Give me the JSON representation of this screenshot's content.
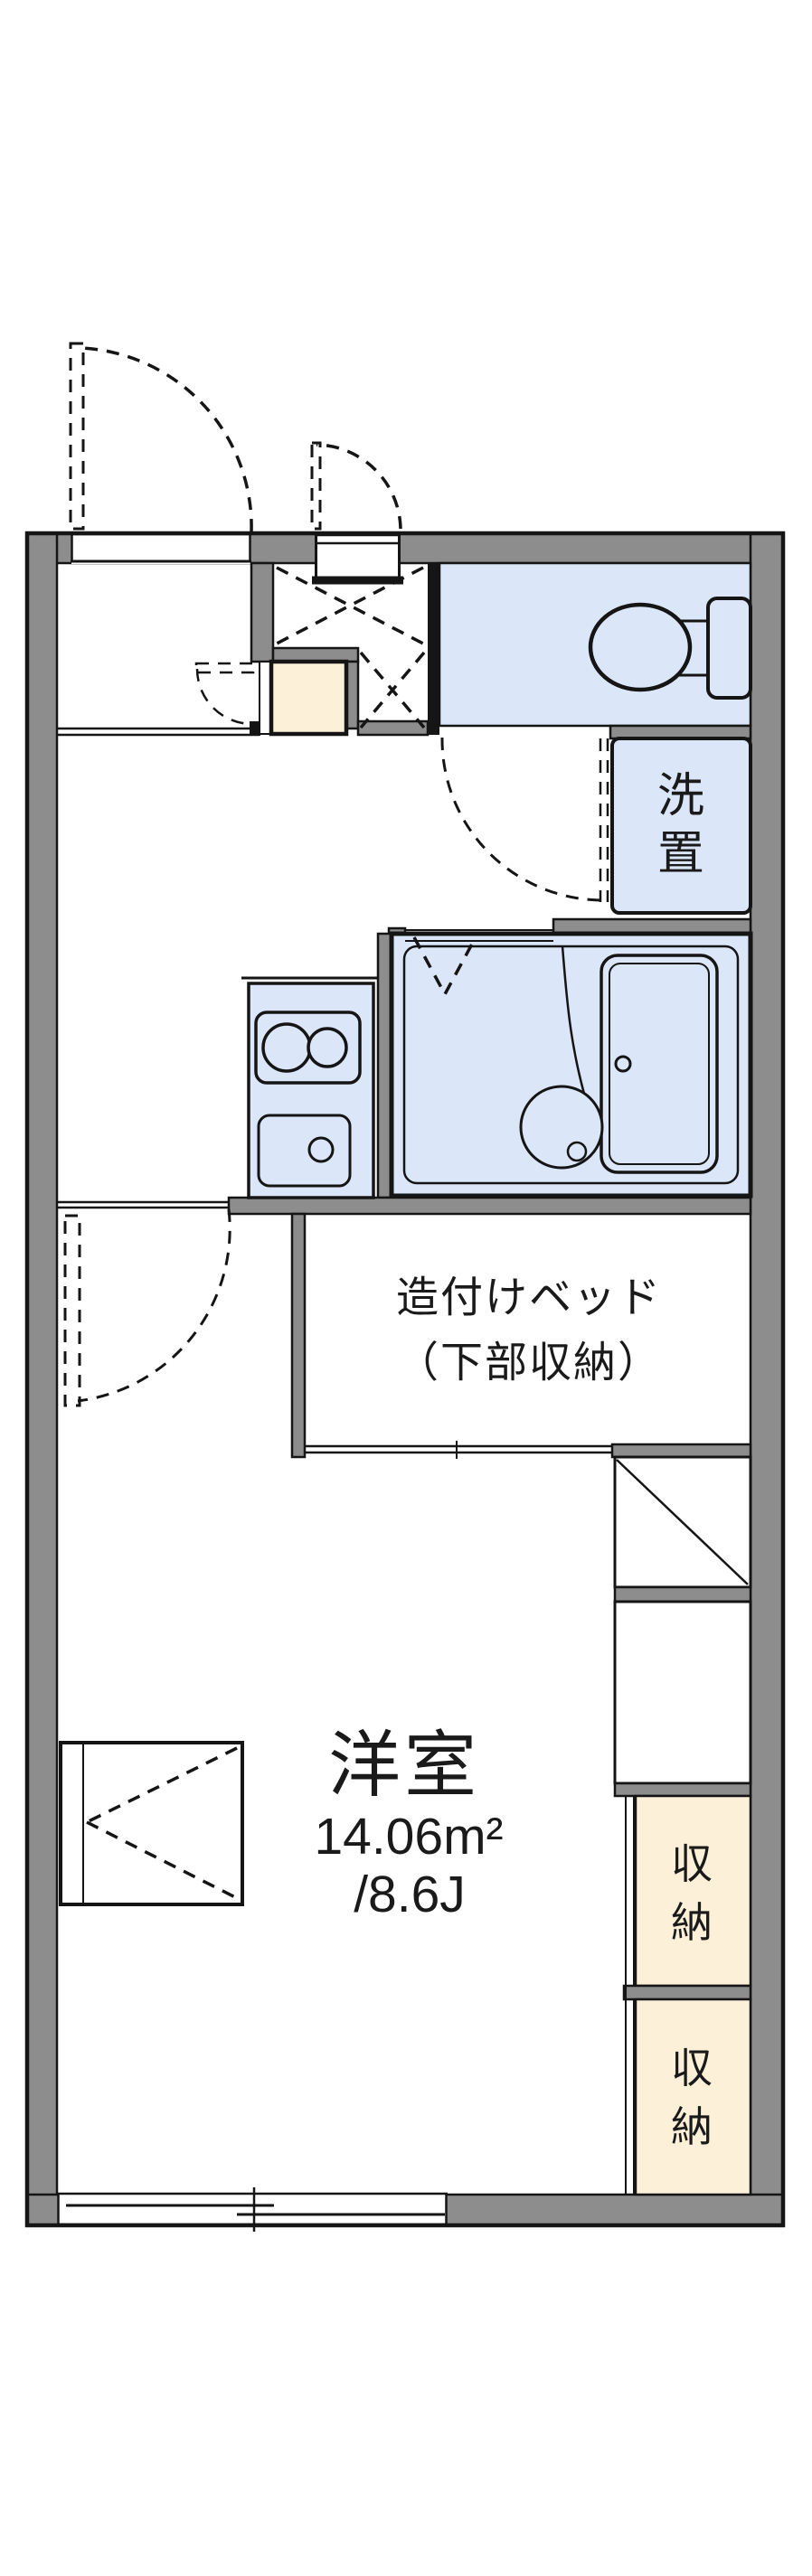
{
  "colors": {
    "wall": "#8d8d8d",
    "outline": "#151515",
    "water": "#dbe7f8",
    "tile": "#fcf0d9",
    "text": "#1a1a1a",
    "bg": "#ffffff"
  },
  "floor_plan": {
    "main_room": {
      "name": "洋室",
      "area_m2": "14.06m²",
      "area_tatami": "/8.6J"
    },
    "built_in_bed": {
      "line1": "造付けベッド",
      "line2": "（下部収納）"
    },
    "washer_space": {
      "char1": "洗",
      "char2": "置"
    },
    "closet_upper": {
      "char1": "収",
      "char2": "納"
    },
    "closet_lower": {
      "char1": "収",
      "char2": "納"
    }
  }
}
